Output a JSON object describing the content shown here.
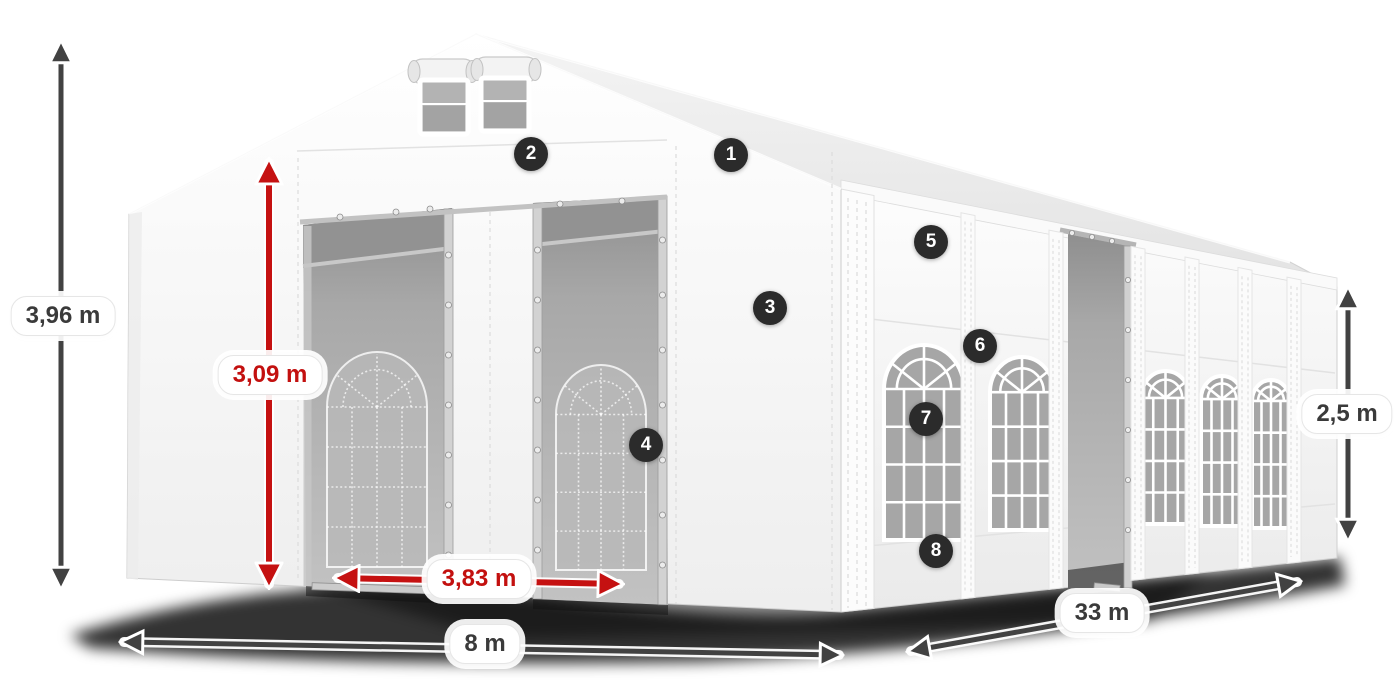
{
  "diagram": {
    "subject": "White marquee party tent with dimension annotations",
    "background": "#ffffff"
  },
  "dims": {
    "total_height": "3,96 m",
    "entrance_height": "3,09 m",
    "entrance_width": "3,83 m",
    "width": "8 m",
    "length": "33 m",
    "side_height": "2,5 m"
  },
  "markers": [
    "1",
    "2",
    "3",
    "4",
    "5",
    "6",
    "7",
    "8"
  ],
  "colors": {
    "dimension_red": "#c51111",
    "dimension_dark": "#424242",
    "marker_background": "#2b2b2b",
    "label_background": "#ffffff",
    "tent_white": "#f5f5f5",
    "interior_gray": "#a6a6a6"
  }
}
